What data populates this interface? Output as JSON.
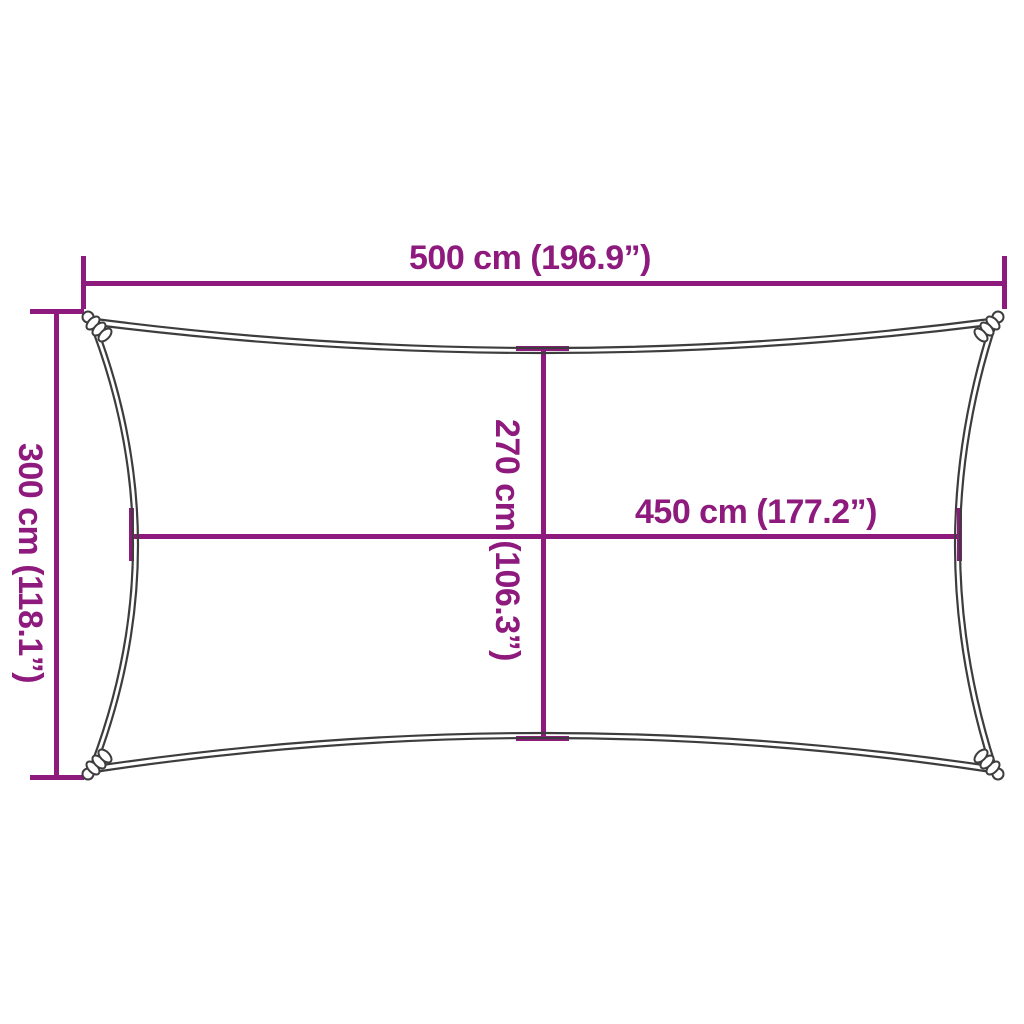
{
  "diagram": {
    "type": "product-dimension-diagram",
    "subject": "rectangular shade sail, top view, concave edges with corner rings",
    "colors": {
      "accent": "#8E1A7D",
      "outline": "#3D3D3D",
      "background": "#FFFFFF"
    },
    "dimensions": {
      "outer_width": {
        "label": "500 cm (196.9”)",
        "cm": 500,
        "inches": 196.9,
        "position": "top"
      },
      "outer_height": {
        "label": "300 cm (118.1”)",
        "cm": 300,
        "inches": 118.1,
        "position": "left"
      },
      "inner_height": {
        "label": "270 cm (106.3”)",
        "cm": 270,
        "inches": 106.3,
        "position": "center-vertical"
      },
      "inner_width": {
        "label": "450 cm (177.2”)",
        "cm": 450,
        "inches": 177.2,
        "position": "center-horizontal"
      }
    }
  }
}
